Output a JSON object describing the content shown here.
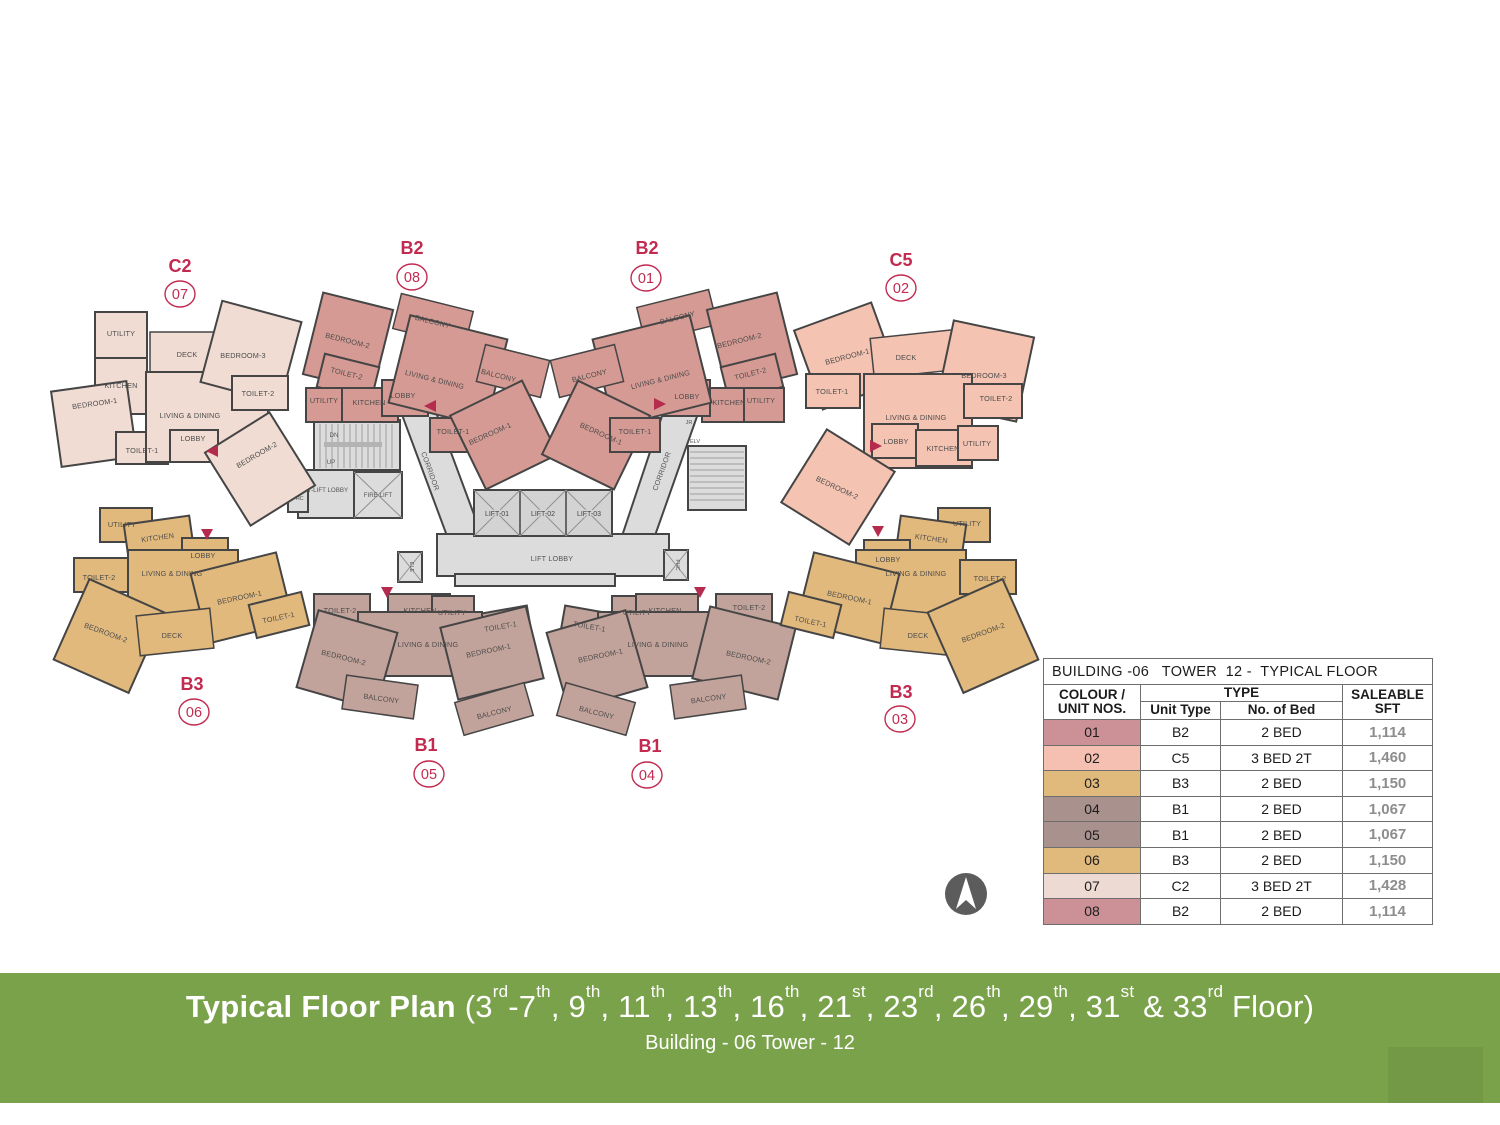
{
  "plan": {
    "units": [
      {
        "type": "C2",
        "number": "07",
        "color": "#f0dcd3",
        "rooms": [
          "UTILITY",
          "KITCHEN",
          "BEDROOM-1",
          "TOILET-1",
          "DECK",
          "LIVING & DINING",
          "LOBBY",
          "BEDROOM-3",
          "TOILET-2",
          "BEDROOM-2"
        ]
      },
      {
        "type": "B2",
        "number": "08",
        "color": "#d59a93",
        "rooms": [
          "BEDROOM-2",
          "BALCONY",
          "TOILET-2",
          "UTILITY",
          "KITCHEN",
          "LOBBY",
          "LIVING & DINING",
          "BALCONY",
          "TOILET-1",
          "BEDROOM-1"
        ]
      },
      {
        "type": "B2",
        "number": "01",
        "color": "#d59a93",
        "rooms": [
          "BALCONY",
          "BEDROOM-2",
          "TOILET-2",
          "KITCHEN",
          "UTILITY",
          "LOBBY",
          "LIVING & DINING",
          "BALCONY",
          "BEDROOM-1",
          "TOILET-1"
        ]
      },
      {
        "type": "C5",
        "number": "02",
        "color": "#f4c3b2",
        "rooms": [
          "BEDROOM-1",
          "DECK",
          "BEDROOM-3",
          "TOILET-1",
          "LIVING & DINING",
          "TOILET-2",
          "LOBBY",
          "KITCHEN",
          "UTILITY",
          "BEDROOM-2"
        ]
      },
      {
        "type": "B3",
        "number": "06",
        "color": "#e2b97c",
        "rooms": [
          "UTILITY",
          "KITCHEN",
          "LOBBY",
          "TOILET-2",
          "LIVING & DINING",
          "BEDROOM-1",
          "TOILET-1",
          "BEDROOM-2",
          "DECK"
        ]
      },
      {
        "type": "B1",
        "number": "05",
        "color": "#c2a39b",
        "rooms": [
          "TOILET-2",
          "KITCHEN",
          "UTILITY",
          "TOILET-1",
          "LIVING & DINING",
          "BEDROOM-2",
          "BEDROOM-1",
          "BALCONY",
          "BALCONY"
        ]
      },
      {
        "type": "B1",
        "number": "04",
        "color": "#c2a39b",
        "rooms": [
          "TOILET-1",
          "UTILITY",
          "KITCHEN",
          "TOILET-2",
          "LIVING & DINING",
          "BEDROOM-1",
          "BEDROOM-2",
          "BALCONY",
          "BALCONY"
        ]
      },
      {
        "type": "B3",
        "number": "03",
        "color": "#e2b97c",
        "rooms": [
          "UTILITY",
          "KITCHEN",
          "LOBBY",
          "LIVING & DINING",
          "TOILET-2",
          "BEDROOM-1",
          "TOILET-1",
          "DECK",
          "BEDROOM-2"
        ]
      }
    ],
    "core": {
      "lifts": [
        "LIFT-01",
        "LIFT-02",
        "LIFT-03"
      ],
      "lift_lobby": "LIFT LOBBY",
      "corridor": "CORRIDOR",
      "fire_lift": "FIRE LIFT",
      "ft_lift_lobby": "FT-LIFT LOBBY",
      "dn": "DN",
      "up": "UP",
      "fhc": "FHC",
      "ele": "ELE",
      "elv": "ELV",
      "jr": "JR"
    }
  },
  "table": {
    "title": "BUILDING -06   TOWER  12 -  TYPICAL FLOOR",
    "col_unit": "COLOUR / UNIT NOS.",
    "col_type_group": "TYPE",
    "col_unit_type": "Unit Type",
    "col_bed": "No. of Bed",
    "col_sft": "SALEABLE SFT",
    "rows": [
      {
        "no": "01",
        "color": "#cb9197",
        "type": "B2",
        "bed": "2 BED",
        "sft": "1,114"
      },
      {
        "no": "02",
        "color": "#f5c0b2",
        "type": "C5",
        "bed": "3 BED 2T",
        "sft": "1,460"
      },
      {
        "no": "03",
        "color": "#e0b97c",
        "type": "B3",
        "bed": "2 BED",
        "sft": "1,150"
      },
      {
        "no": "04",
        "color": "#a9918e",
        "type": "B1",
        "bed": "2 BED",
        "sft": "1,067"
      },
      {
        "no": "05",
        "color": "#a9918e",
        "type": "B1",
        "bed": "2 BED",
        "sft": "1,067"
      },
      {
        "no": "06",
        "color": "#e0b97c",
        "type": "B3",
        "bed": "2 BED",
        "sft": "1,150"
      },
      {
        "no": "07",
        "color": "#eddbd3",
        "type": "C2",
        "bed": "3 BED 2T",
        "sft": "1,428"
      },
      {
        "no": "08",
        "color": "#cb9197",
        "type": "B2",
        "bed": "2 BED",
        "sft": "1,114"
      }
    ],
    "accent_border": "#6e6e6e"
  },
  "footer": {
    "title_bold": "Typical Floor Plan",
    "title_floors": [
      [
        "(3",
        "rd"
      ],
      [
        "-7",
        "th"
      ],
      [
        ", 9",
        "th"
      ],
      [
        ", 11",
        "th"
      ],
      [
        ", 13",
        "th"
      ],
      [
        ", 16",
        "th"
      ],
      [
        ", 21",
        "st"
      ],
      [
        ", 23",
        "rd"
      ],
      [
        ", 26",
        "th"
      ],
      [
        ", 29",
        "th"
      ],
      [
        ", 31",
        "st"
      ],
      [
        " & 33",
        "rd"
      ],
      [
        " Floor)",
        null
      ]
    ],
    "subtitle": "Building - 06 Tower - 12",
    "band_color": "#7aa24b"
  },
  "north_arrow": "N"
}
